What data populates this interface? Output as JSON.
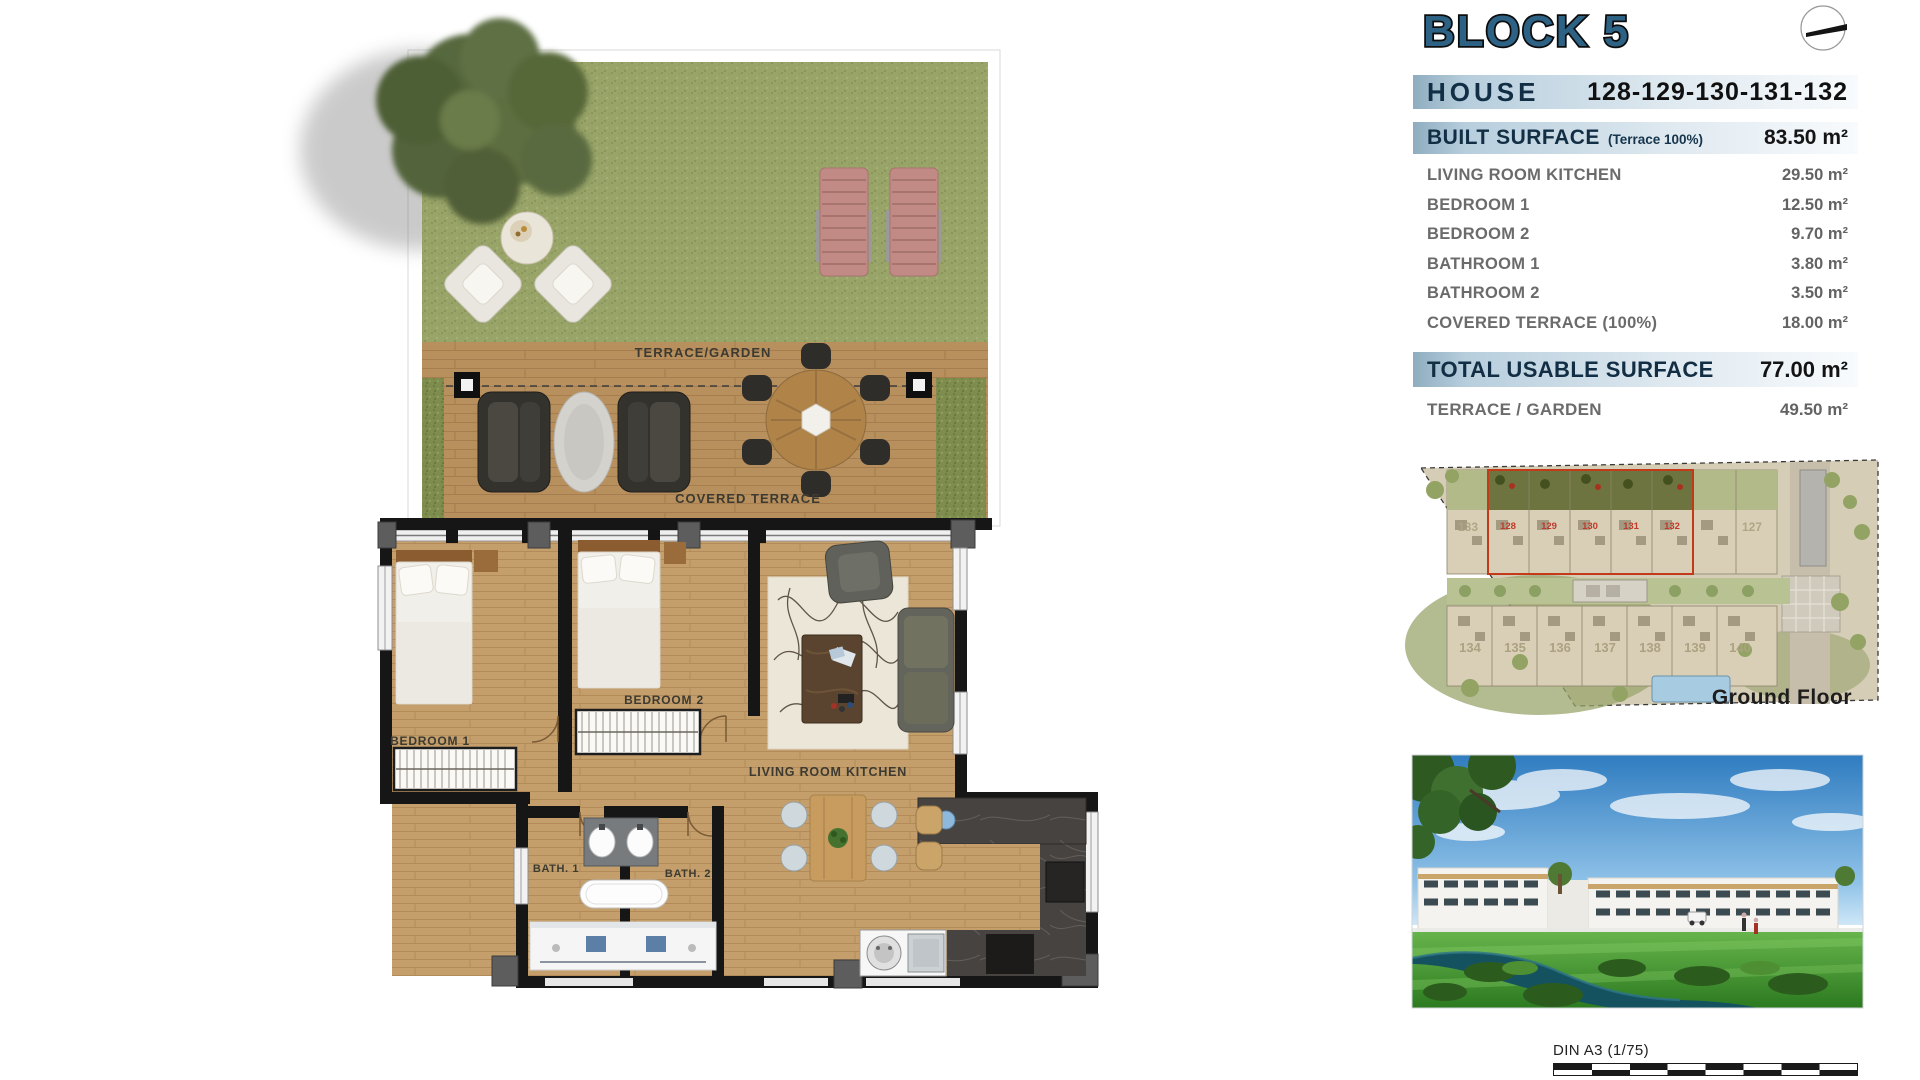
{
  "panel": {
    "block_title": "BLOCK 5",
    "house": {
      "label": "HOUSE",
      "numbers": "128-129-130-131-132"
    },
    "built_surface": {
      "label": "BUILT SURFACE",
      "note": "(Terrace 100%)",
      "value": "83.50 m²"
    },
    "rows": [
      {
        "label": "LIVING ROOM KITCHEN",
        "value": "29.50 m²"
      },
      {
        "label": "BEDROOM 1",
        "value": "12.50 m²"
      },
      {
        "label": "BEDROOM 2",
        "value": "9.70 m²"
      },
      {
        "label": "BATHROOM 1",
        "value": "3.80 m²"
      },
      {
        "label": "BATHROOM 2",
        "value": "3.50 m²"
      },
      {
        "label": "COVERED TERRACE (100%)",
        "value": "18.00 m²"
      }
    ],
    "total": {
      "label": "TOTAL USABLE SURFACE",
      "value": "77.00 m²"
    },
    "terrace_garden": {
      "label": "TERRACE / GARDEN",
      "value": "49.50 m²"
    }
  },
  "floor_plan": {
    "labels": {
      "terrace_garden": "TERRACE/GARDEN",
      "covered_terrace": "COVERED TERRACE",
      "bedroom1": "BEDROOM 1",
      "bedroom2": "BEDROOM 2",
      "living": "LIVING ROOM KITCHEN",
      "bath1": "BATH. 1",
      "bath2": "BATH. 2"
    }
  },
  "site_plan": {
    "caption": "Ground Floor",
    "top_numbers": [
      "133",
      "128",
      "129",
      "130",
      "131",
      "132",
      "127"
    ],
    "bottom_numbers": [
      "134",
      "135",
      "136",
      "137",
      "138",
      "139",
      "140"
    ]
  },
  "footer": {
    "scale_label": "DIN A3 (1/75)"
  },
  "colors": {
    "steel_blue_title": "#2d6285",
    "navy_text": "#112e44",
    "bar_blue": "#9fbdd1",
    "row_gray": "#6b6b6b",
    "highlight_red": "#c0392b",
    "grass_green": "#96a264",
    "wood_tan": "#bf9c6a",
    "marble_dark": "#474340",
    "water_teal": "#14525f",
    "sky_blue": "#3a83c4"
  }
}
